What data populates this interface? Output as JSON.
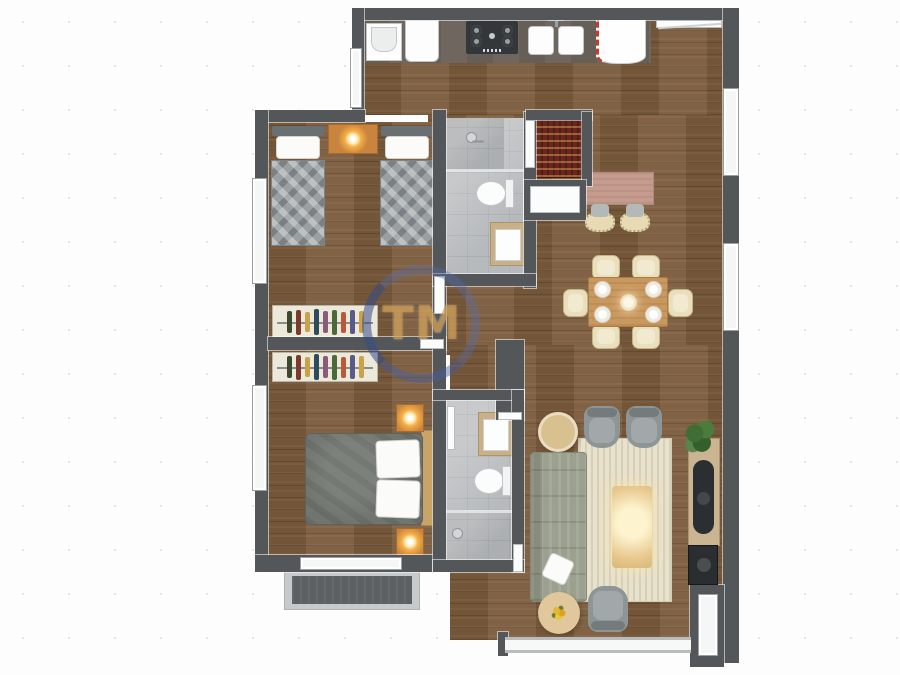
{
  "watermark": {
    "text": "TM",
    "ring_color": "#566EAA",
    "text_color": "#C8903A"
  },
  "palette": {
    "wall": "#53575a",
    "wood_floor": "#7a5a3b",
    "bath_tile": "#b7babc",
    "counter": "#6f675f",
    "accent_orange": "#c9853f",
    "rug": "#e8e1cc",
    "sofa": "#9ba18e",
    "red_shelf": "#6e241c",
    "balcony_floor": "#5c6062",
    "background": "#fdfdfd"
  },
  "floorplan": {
    "type": "2-bedroom apartment, 3D top-down render",
    "rooms": [
      {
        "name": "kitchen",
        "furniture": [
          "utility-sink",
          "cabinet",
          "gas-hob-4-burner",
          "double-sink",
          "refrigerator",
          "breakfast-island",
          "bar-stool",
          "bar-stool",
          "red-pantry-shelf",
          "appliance-niche"
        ]
      },
      {
        "name": "dining-area",
        "furniture": [
          "dining-table",
          "dining-chair x6",
          "plate x4",
          "centerpiece-bowl"
        ]
      },
      {
        "name": "twin-bedroom",
        "furniture": [
          "single-bed x2",
          "nightstand-with-lamp",
          "open-wardrobe"
        ]
      },
      {
        "name": "master-bedroom",
        "furniture": [
          "double-bed",
          "nightstand-with-lamp x2",
          "open-wardrobe"
        ]
      },
      {
        "name": "bathroom-top",
        "furniture": [
          "shower",
          "toilet",
          "vanity-sink"
        ]
      },
      {
        "name": "bathroom-bottom",
        "furniture": [
          "shower",
          "toilet",
          "vanity-sink"
        ]
      },
      {
        "name": "living-room",
        "furniture": [
          "sofa",
          "armchair x3",
          "area-rug",
          "coffee-table",
          "round-side-table",
          "flower-ottoman",
          "tv-console",
          "tv",
          "speaker",
          "potted-plant"
        ]
      },
      {
        "name": "balcony",
        "furniture": []
      }
    ]
  }
}
